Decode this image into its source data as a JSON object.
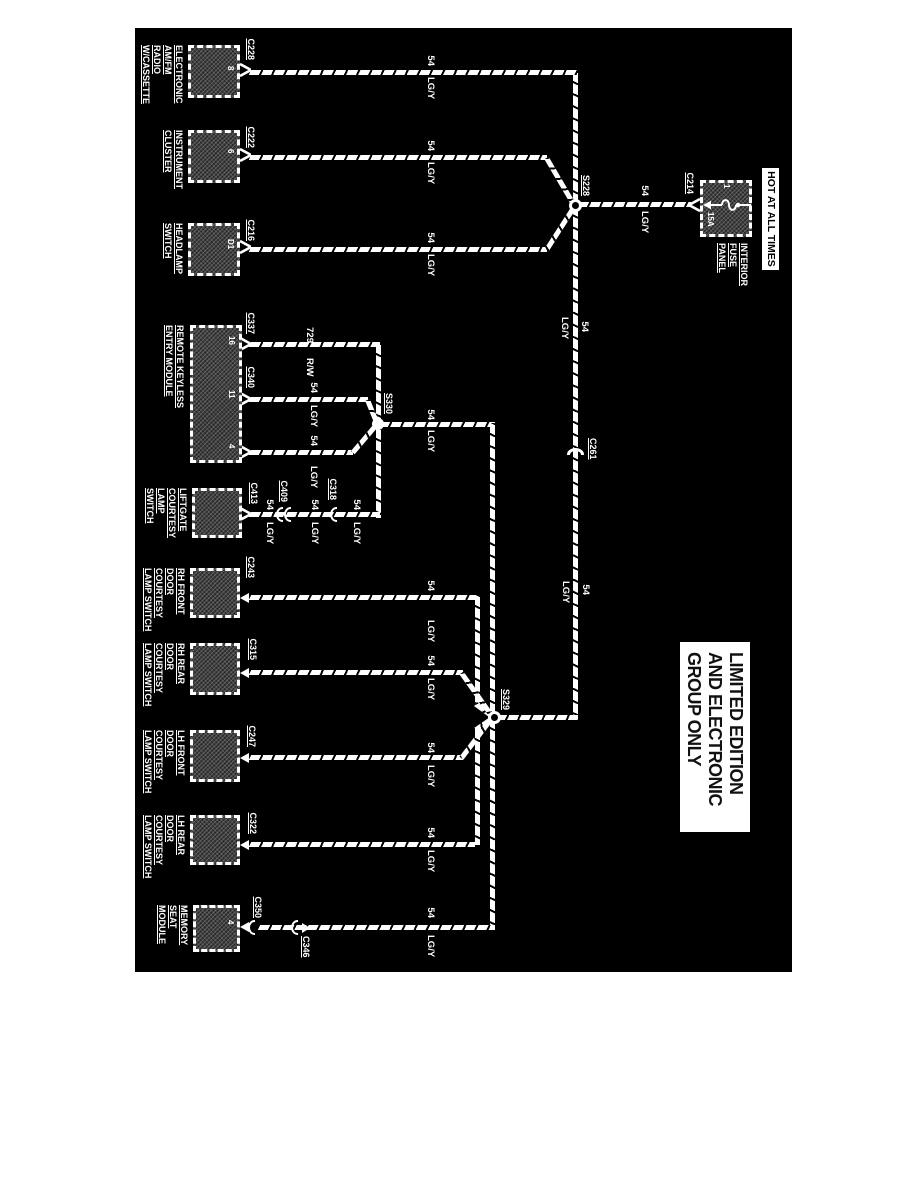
{
  "banner": "HOT AT ALL TIMES",
  "note": {
    "line1": "LIMITED EDITION",
    "line2": "AND ELECTRONIC",
    "line3": "GROUP ONLY"
  },
  "power": {
    "name1": "INTERIOR",
    "name2": "FUSE",
    "name3": "PANEL",
    "fuse_id": "1",
    "fuse_rating": "15A",
    "connector": "C214"
  },
  "splices": {
    "s228": "S228",
    "s330": "S330",
    "s329": "S329"
  },
  "inline": {
    "c261": "C261",
    "c409": "C409",
    "c318": "C318",
    "c346": "C346"
  },
  "components": {
    "radio": {
      "lines": [
        "ELECTRONIC",
        "AM/FM",
        "RADIO",
        "W/CASSETTE"
      ],
      "connector": "C228",
      "pin": "8"
    },
    "cluster": {
      "lines": [
        "INSTRUMENT",
        "CLUSTER"
      ],
      "connector": "C222",
      "pin": "6"
    },
    "headlamp": {
      "lines": [
        "HEADLAMP",
        "SWITCH"
      ],
      "connector": "C216",
      "pin": "D1"
    },
    "rke": {
      "lines": [
        "REMOTE KEYLESS",
        "ENTRY MODULE"
      ],
      "connector1": "C337",
      "pin1": "16",
      "connector2": "C340",
      "pin2": "11",
      "pin3": "4"
    },
    "liftgate": {
      "lines": [
        "LIFTGATE",
        "COURTESY",
        "LAMP",
        "SWITCH"
      ],
      "connector": "C413"
    },
    "rhfront": {
      "lines": [
        "RH FRONT",
        "DOOR",
        "COURTESY",
        "LAMP SWITCH"
      ],
      "connector": "C243"
    },
    "rhrear": {
      "lines": [
        "RH REAR",
        "DOOR",
        "COURTESY",
        "LAMP SWITCH"
      ],
      "connector": "C315"
    },
    "lhfront": {
      "lines": [
        "LH FRONT",
        "DOOR",
        "COURTESY",
        "LAMP SWITCH"
      ],
      "connector": "C247"
    },
    "lhrear": {
      "lines": [
        "LH REAR",
        "DOOR",
        "COURTESY",
        "LAMP SWITCH"
      ],
      "connector": "C322"
    },
    "memory": {
      "lines": [
        "MEMORY",
        "SEAT",
        "MODULE"
      ],
      "connector": "C350",
      "pin": "4"
    }
  },
  "wires": {
    "radio": {
      "num": "54",
      "color": "LG/Y"
    },
    "cluster": {
      "num": "54",
      "color": "LG/Y"
    },
    "headlamp": {
      "num": "54",
      "color": "LG/Y"
    },
    "feed1": {
      "num": "54",
      "color": "LG/Y"
    },
    "feed2": {
      "num": "54",
      "color": "LG/Y"
    },
    "rke729": {
      "num": "729",
      "color": "R/W"
    },
    "rke340": {
      "num": "54",
      "color": "LG/Y"
    },
    "rke4": {
      "num": "54",
      "color": "LG/Y"
    },
    "lift1": {
      "num": "54",
      "color": "LG/Y"
    },
    "lift2": {
      "num": "54",
      "color": "LG/Y"
    },
    "lift3": {
      "num": "54",
      "color": "LG/Y"
    },
    "s330out": {
      "num": "54",
      "color": "LG/Y"
    },
    "rhfront": {
      "num": "54",
      "color": "LG/Y"
    },
    "rhrear": {
      "num": "54",
      "color": "LG/Y"
    },
    "lhfront": {
      "num": "54",
      "color": "LG/Y"
    },
    "lhrear": {
      "num": "54",
      "color": "LG/Y"
    },
    "memory": {
      "num": "54",
      "color": "LG/Y"
    }
  },
  "colors": {
    "background": "#000000",
    "wire": "#ffffff",
    "page": "#ffffff"
  }
}
